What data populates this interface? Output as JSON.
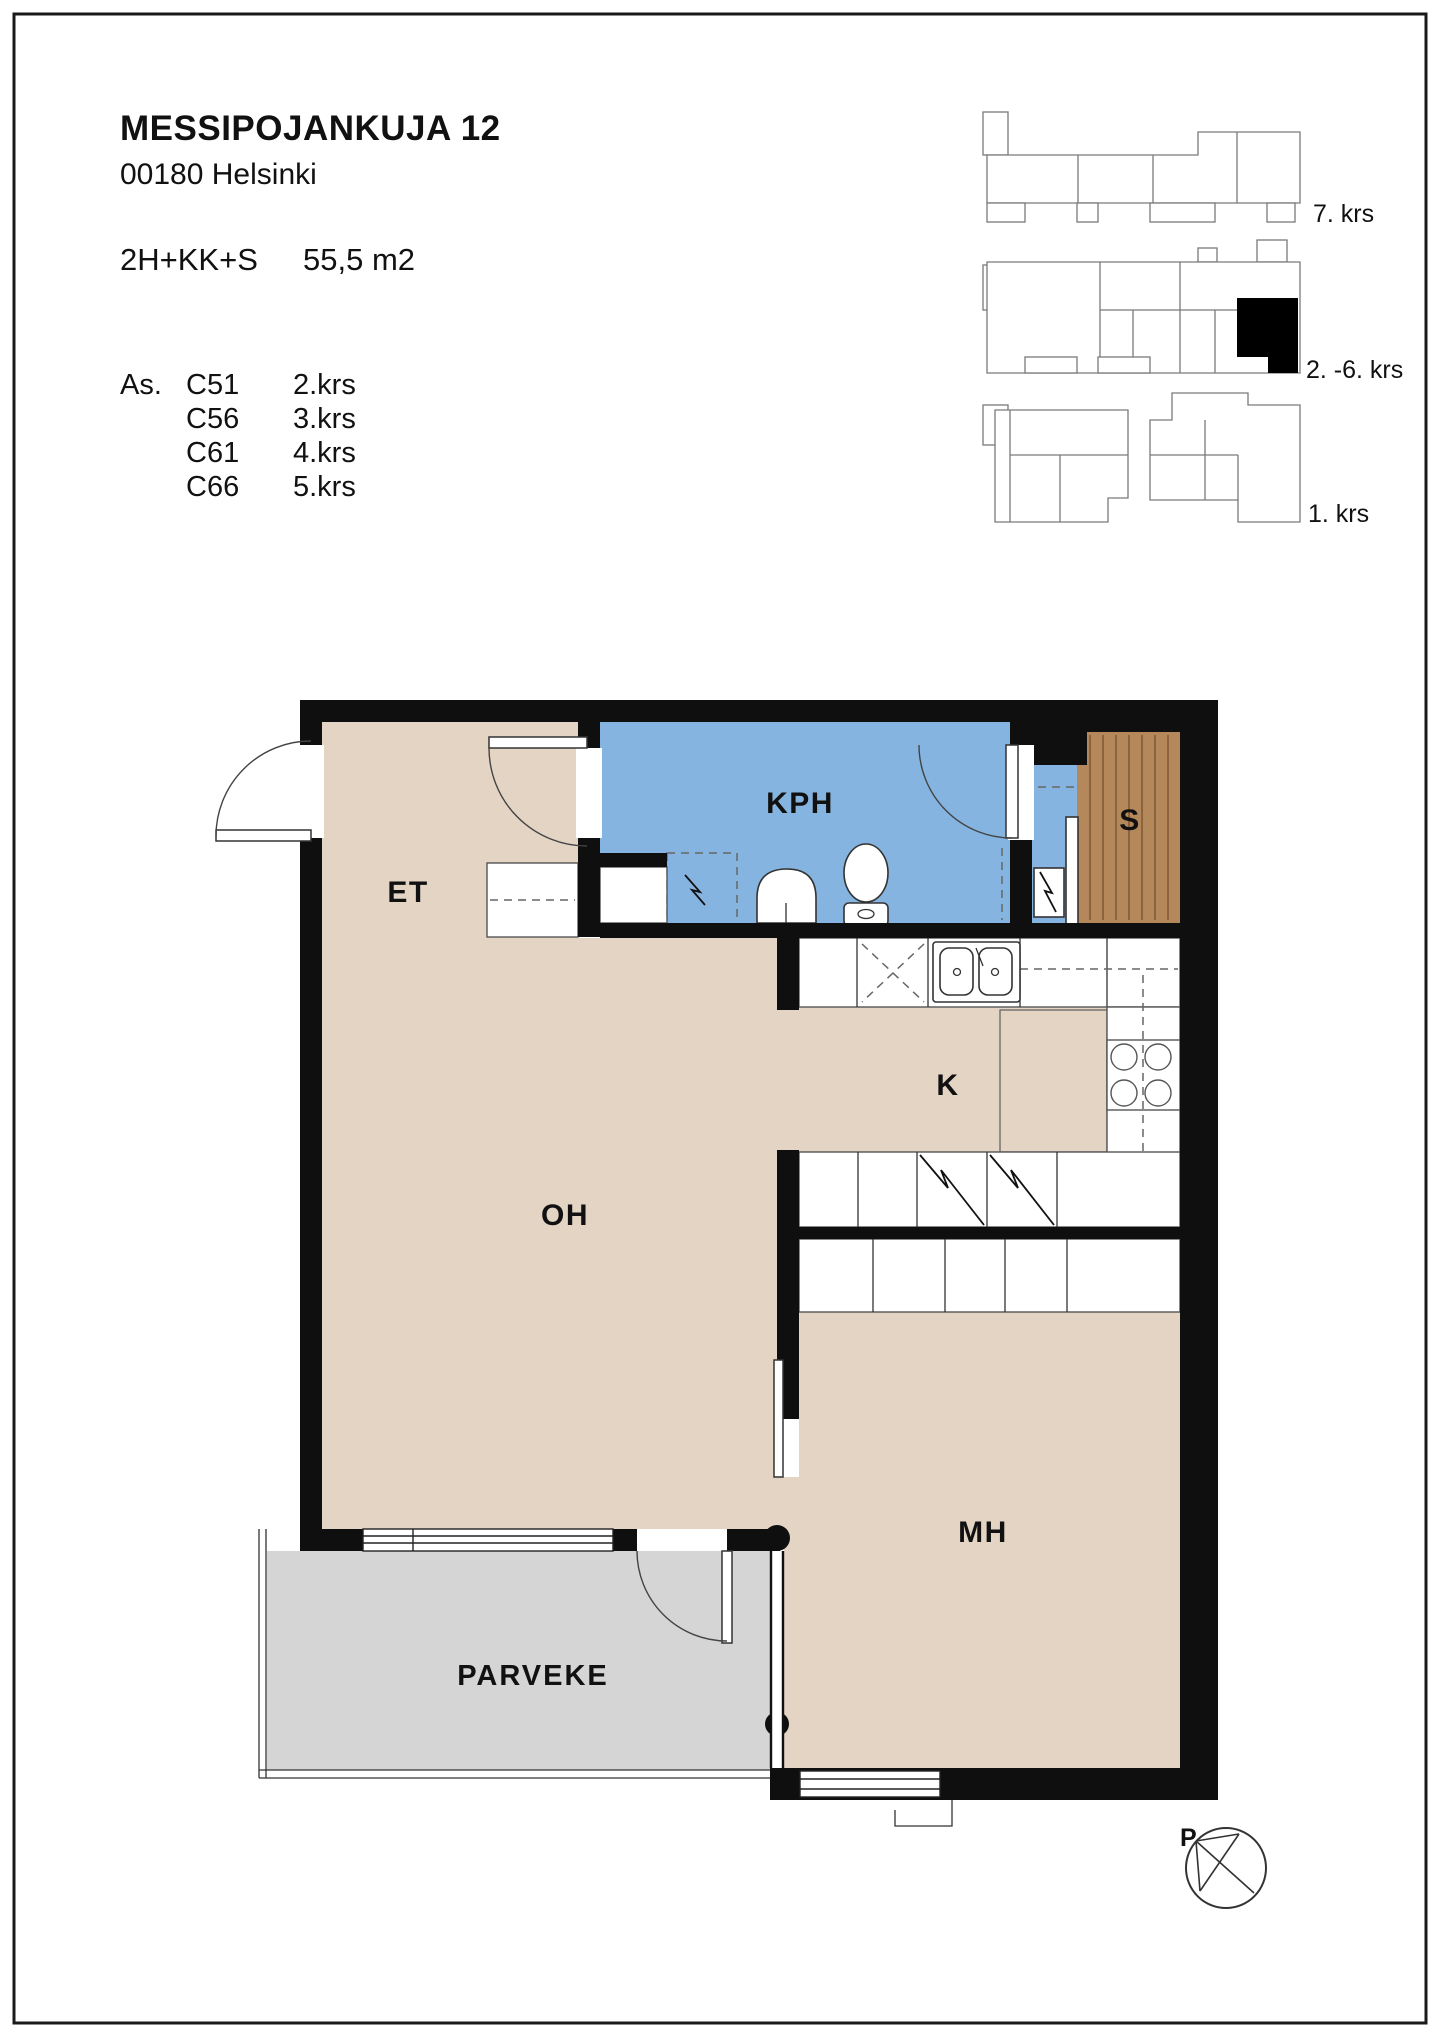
{
  "header": {
    "title": "MESSIPOJANKUJA 12",
    "address": "00180 Helsinki",
    "apartment_type": "2H+KK+S",
    "area": "55,5 m2",
    "apartments_prefix": "As.",
    "apartments": [
      {
        "code": "C51",
        "floor": "2.krs"
      },
      {
        "code": "C56",
        "floor": "3.krs"
      },
      {
        "code": "C61",
        "floor": "4.krs"
      },
      {
        "code": "C66",
        "floor": "5.krs"
      }
    ]
  },
  "key_diagrams": {
    "floor7_label": "7. krs",
    "floors2to6_label": "2. -6. krs",
    "floor1_label": "1. krs"
  },
  "floor_plan": {
    "rooms": {
      "et": "ET",
      "kph": "KPH",
      "sauna": "S",
      "kitchen": "K",
      "oh": "OH",
      "mh": "MH",
      "balcony": "PARVEKE"
    },
    "compass_north": "P"
  },
  "colors": {
    "wall": "#0f0f0f",
    "floor_tan": "#e3d4c4",
    "wet_blue": "#86b4e0",
    "sauna_wood": "#b4885a",
    "balcony_gray": "#d5d5d5"
  }
}
